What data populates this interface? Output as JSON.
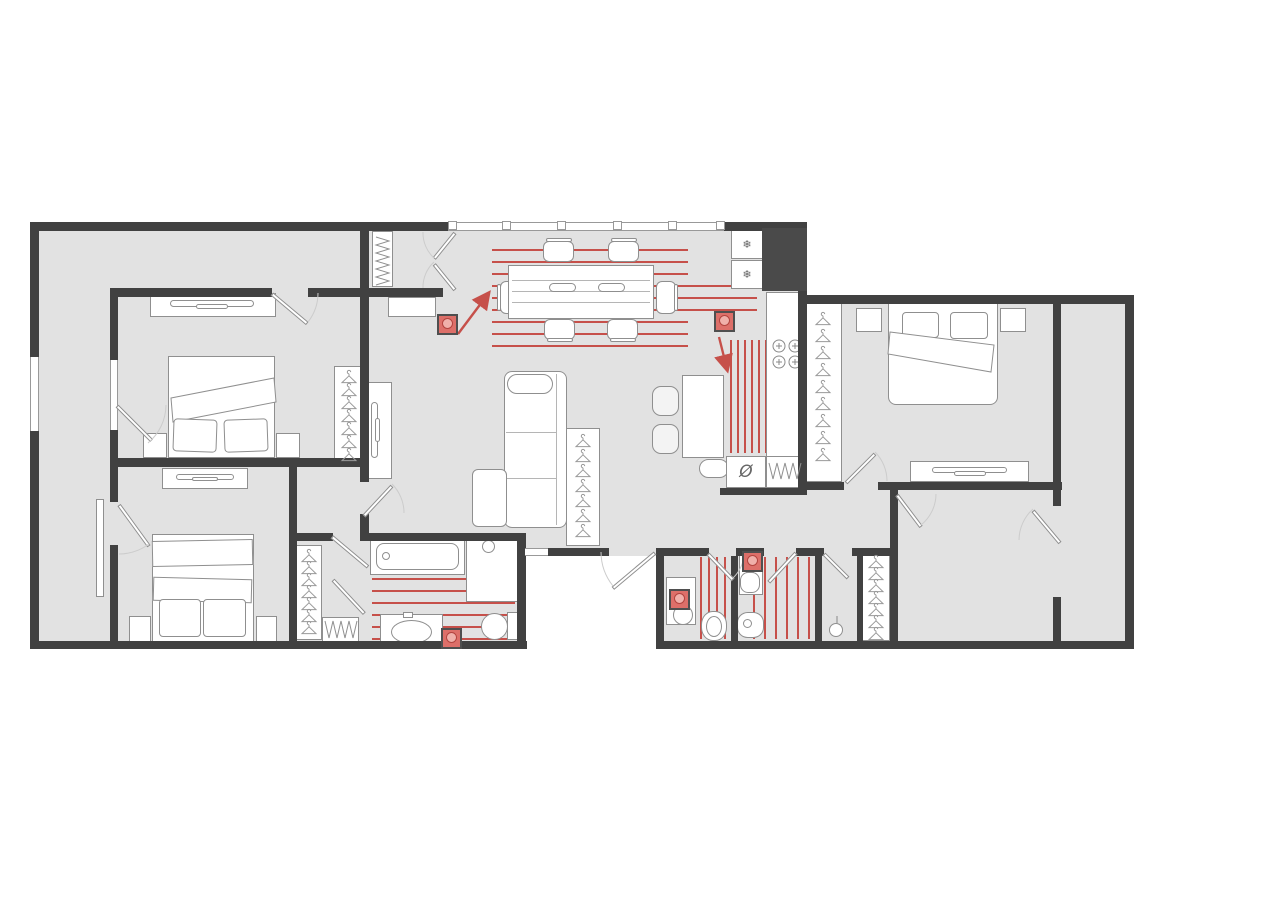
{
  "meta": {
    "title": "Apartment floor plan with underfloor heating zones",
    "type": "floor-plan"
  },
  "colors": {
    "wall": "#414141",
    "floor": "#e2e2e2",
    "stroke": "#8f8f8f",
    "red": "#c6504a",
    "thermo-fill": "#dd6f69",
    "thermo-inner": "#f0b0aa",
    "arc": "#cccccc"
  },
  "icons": {
    "freezer": "❄",
    "sink": "Ø"
  },
  "window_mullions": {
    "y": 221,
    "size": 9,
    "xs": [
      448,
      502,
      557,
      613,
      668,
      716
    ]
  },
  "heating_zones": [
    {
      "name": "dining",
      "orientation": "h",
      "lines": [
        [
          492,
          249,
          196
        ],
        [
          492,
          261,
          196
        ],
        [
          492,
          273,
          196
        ],
        [
          492,
          285,
          265
        ],
        [
          492,
          297,
          265
        ],
        [
          492,
          309,
          265
        ],
        [
          492,
          321,
          196
        ],
        [
          492,
          333,
          196
        ],
        [
          492,
          345,
          196
        ]
      ]
    },
    {
      "name": "kitchen",
      "orientation": "v",
      "lines": [
        [
          730,
          340,
          113
        ],
        [
          737,
          340,
          113
        ],
        [
          744,
          340,
          113
        ],
        [
          751,
          340,
          113
        ],
        [
          758,
          340,
          113
        ],
        [
          765,
          340,
          113
        ]
      ]
    },
    {
      "name": "bathroom",
      "orientation": "h",
      "lines": [
        [
          372,
          578,
          143
        ],
        [
          372,
          590,
          143
        ],
        [
          372,
          602,
          143
        ],
        [
          372,
          614,
          143
        ],
        [
          372,
          626,
          143
        ],
        [
          372,
          638,
          143
        ]
      ]
    },
    {
      "name": "wc-small",
      "orientation": "v",
      "lines": [
        [
          700,
          557,
          82
        ],
        [
          708,
          557,
          82
        ],
        [
          716,
          557,
          82
        ],
        [
          724,
          557,
          82
        ]
      ]
    },
    {
      "name": "wc-guest",
      "orientation": "v",
      "lines": [
        [
          753,
          557,
          82
        ],
        [
          764,
          557,
          82
        ],
        [
          775,
          557,
          82
        ],
        [
          786,
          557,
          82
        ],
        [
          797,
          557,
          82
        ],
        [
          808,
          557,
          82
        ]
      ]
    }
  ],
  "thermostats": [
    {
      "x": 437,
      "y": 314
    },
    {
      "x": 714,
      "y": 311
    },
    {
      "x": 669,
      "y": 589
    },
    {
      "x": 742,
      "y": 551
    },
    {
      "x": 441,
      "y": 628
    }
  ],
  "arrows": [
    {
      "x1": 458,
      "y1": 334,
      "x2": 488,
      "y2": 294
    },
    {
      "x1": 719,
      "y1": 337,
      "x2": 727,
      "y2": 369
    }
  ],
  "hanger_columns": [
    {
      "name": "bedroom1-closet",
      "cx": 349,
      "y0": 371,
      "count": 7,
      "gap": 13
    },
    {
      "name": "bedroom3-closet",
      "cx": 823,
      "y0": 313,
      "count": 9,
      "gap": 17
    },
    {
      "name": "living-closet",
      "cx": 583,
      "y0": 435,
      "count": 7,
      "gap": 15
    },
    {
      "name": "hall-closet",
      "cx": 309,
      "y0": 550,
      "count": 7,
      "gap": 12
    },
    {
      "name": "dressing-closet",
      "cx": 876,
      "y0": 556,
      "count": 7,
      "gap": 12
    }
  ],
  "zigzags": [
    {
      "name": "entry-closet-rail",
      "x": 375,
      "y": 237,
      "orientation": "v",
      "length": 48,
      "amplitude": 15,
      "step": 4
    },
    {
      "name": "shoe-rack",
      "x": 325,
      "y": 620,
      "orientation": "h",
      "length": 32,
      "amplitude": 19,
      "step": 4
    },
    {
      "name": "dishwasher-coil",
      "x": 769,
      "y": 462,
      "orientation": "h",
      "length": 34,
      "amplitude": 18,
      "step": 4
    }
  ]
}
